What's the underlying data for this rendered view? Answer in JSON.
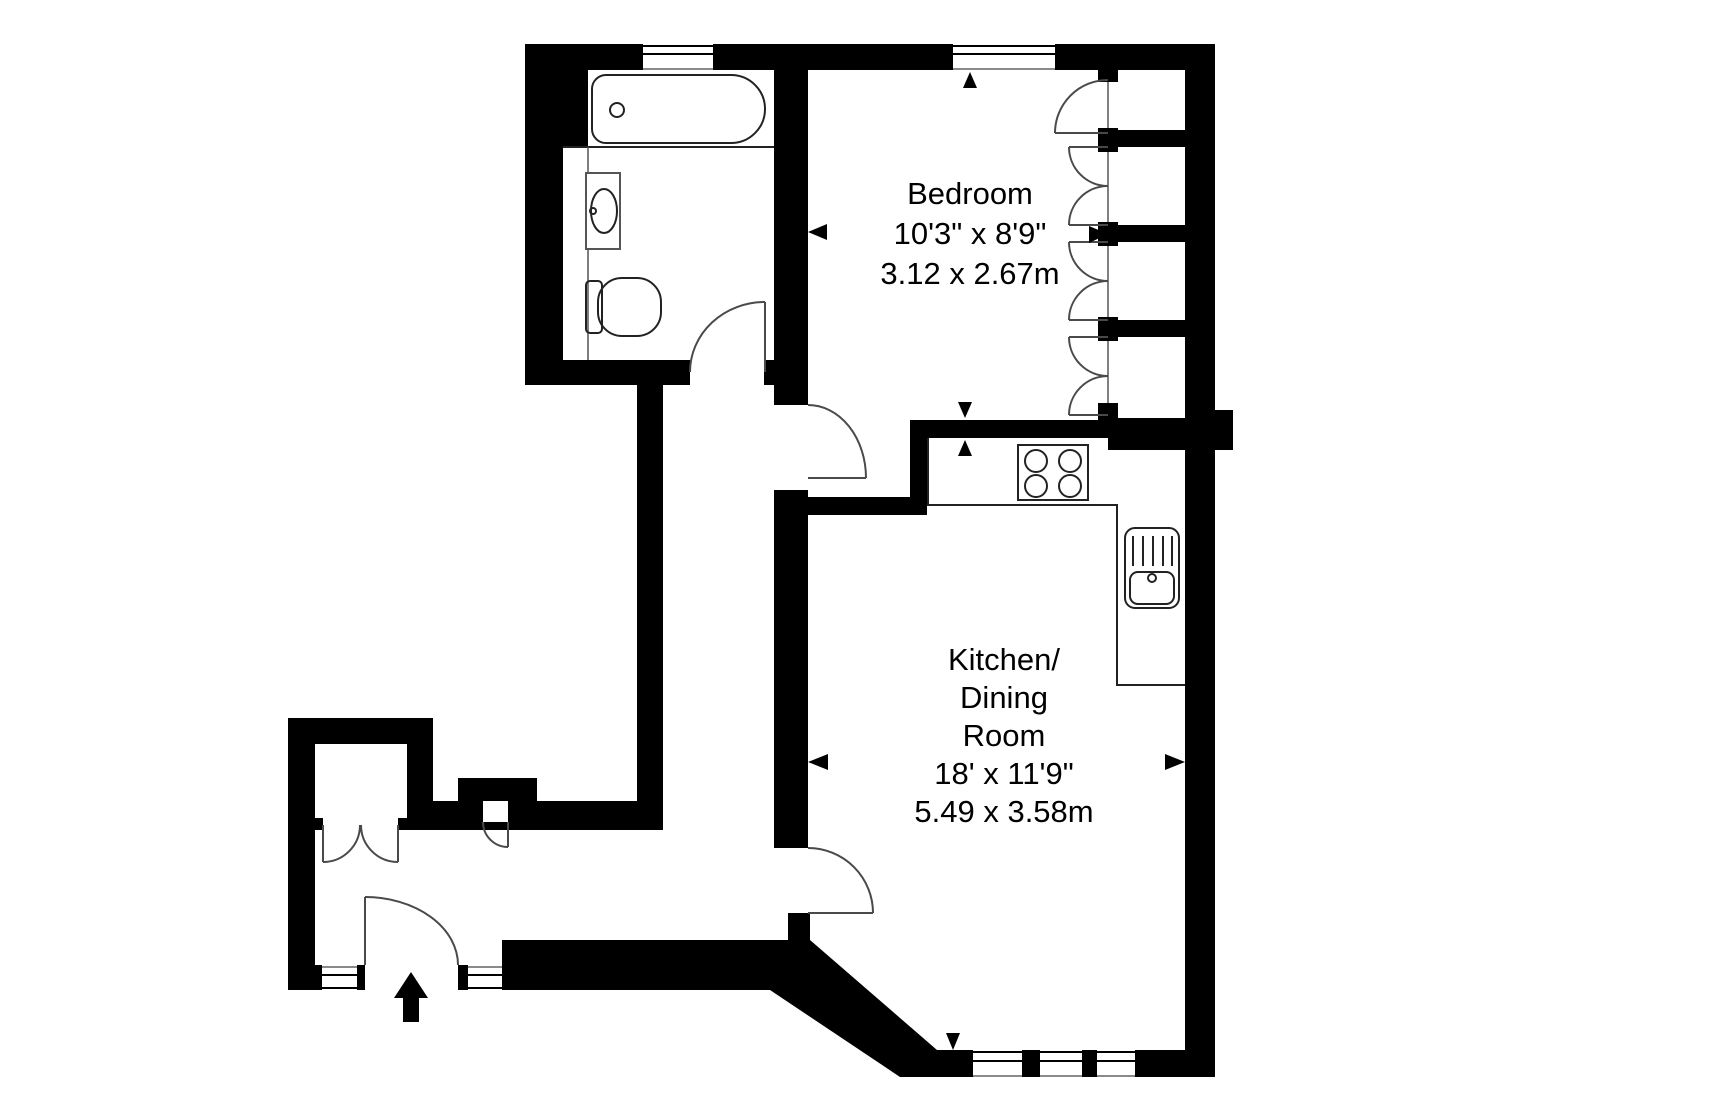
{
  "title": "Apartment floor plan",
  "colors": {
    "background": "#ffffff",
    "wall": "#000000",
    "fixture_line": "#222222",
    "door_line": "#4a4a4a",
    "window_line": "#8a8a8a"
  },
  "rooms": {
    "bedroom": {
      "name": "Bedroom",
      "imperial": "10'3\" x 8'9\"",
      "metric": "3.12 x 2.67m"
    },
    "kitchen_dining": {
      "name_line1": "Kitchen/",
      "name_line2": "Dining",
      "name_line3": "Room",
      "imperial": "18' x 11'9\"",
      "metric": "5.49 x 3.58m"
    },
    "bathroom": {
      "fixtures": [
        "bath-tub",
        "wash-basin",
        "toilet"
      ]
    },
    "hall": {
      "features": [
        "entrance-door",
        "double-door-closet",
        "cupboard"
      ]
    }
  },
  "fixtures": {
    "kitchen": [
      "hob-4-burners",
      "sink-with-drainer",
      "worktop-counter"
    ],
    "bedroom": [
      "built-in-wardrobes-4-doors"
    ]
  },
  "windows": {
    "top_wall": 2,
    "hall_bottom_wall": 2,
    "kitchen_bottom_wall": 3
  },
  "entrance": {
    "symbol": "entrance-arrow-up"
  }
}
